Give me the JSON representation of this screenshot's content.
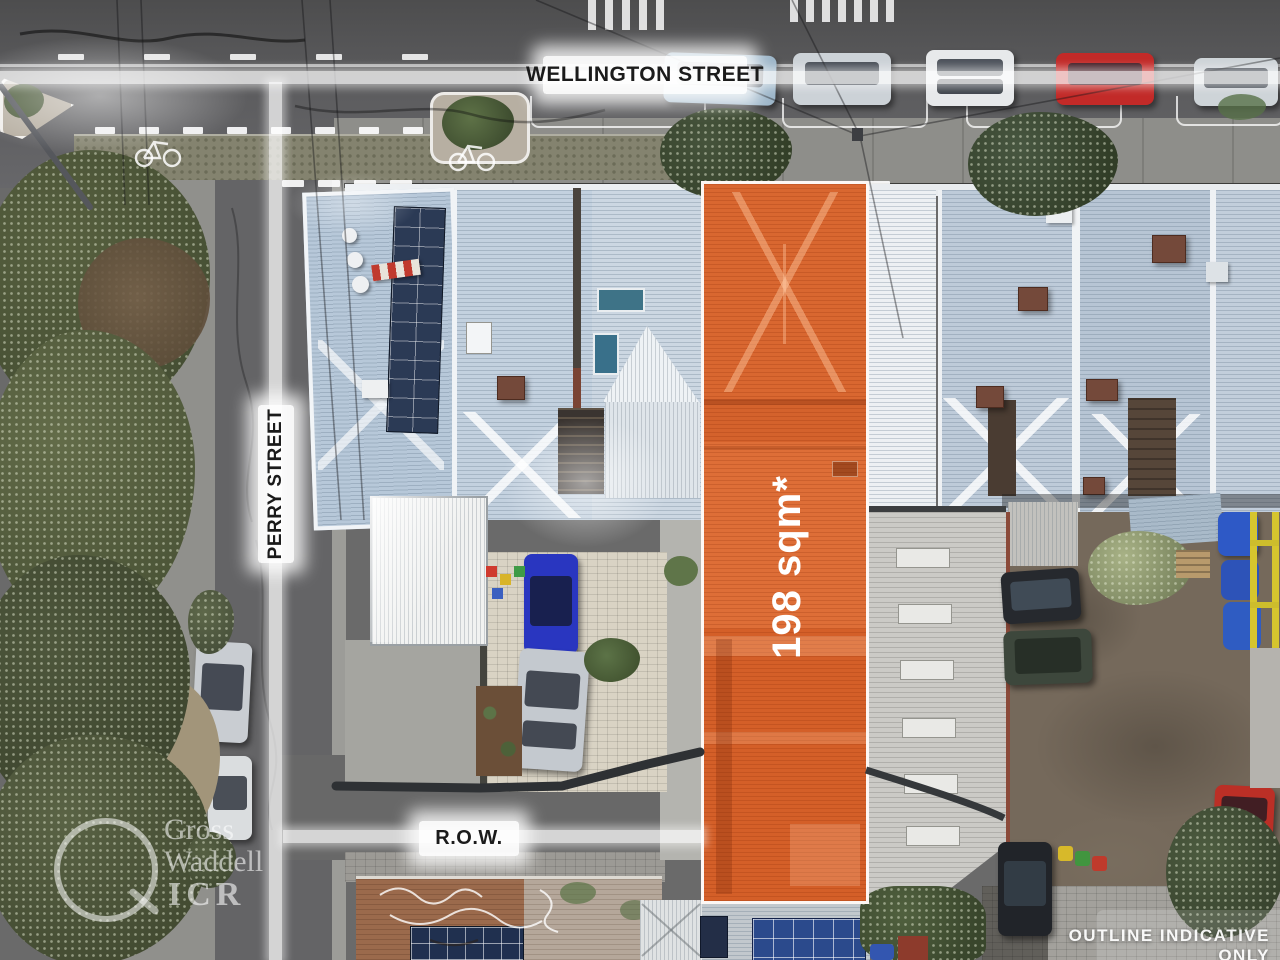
{
  "labels": {
    "wellington": "WELLINGTON STREET",
    "perry": "PERRY STREET",
    "row": "R.O.W.",
    "area": "198 sqm*",
    "disclaimer": "OUTLINE INDICATIVE ONLY"
  },
  "watermark": {
    "line1": "Gross",
    "line2": "Waddell",
    "line3": "ICR"
  },
  "colors": {
    "lot_highlight": "#DC6831",
    "lot_outline": "#FFFFFF",
    "label_text": "#1B1B1B",
    "label_background": "#FFFFFF",
    "area_text": "#FFFFFF",
    "disclaimer_text": "#FFFFFF"
  }
}
